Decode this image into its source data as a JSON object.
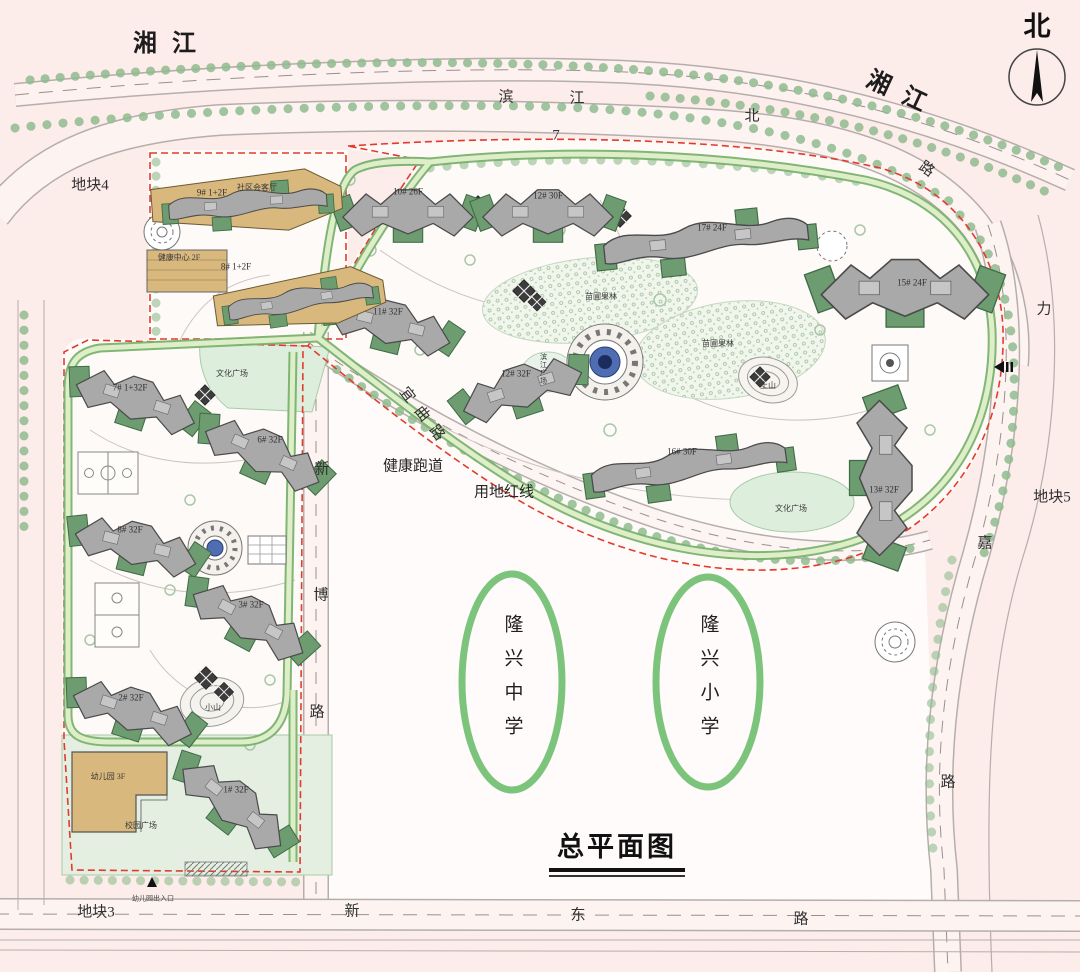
{
  "title": "总平面图",
  "compass": {
    "label": "北"
  },
  "colors": {
    "background": "#fcecea",
    "parcel_fill": "#fefaf8",
    "building_gray": "#a9a9a9",
    "building_green": "#6d9c70",
    "commercial_tan": "#d9b87d",
    "track_green": "#7ab26e",
    "track_inner": "#ddeec9",
    "red_line": "#e23b2e",
    "plaza_green": "#ddeedd",
    "school_ellipse_green": "#7cc47c"
  },
  "schools": [
    {
      "name": "隆兴中学"
    },
    {
      "name": "隆兴小学"
    }
  ],
  "map": {
    "labels": [
      {
        "id": "river-name-left",
        "text": "湘江",
        "x": 172,
        "y": 44,
        "cls": "lbl-lg"
      },
      {
        "id": "river-name-right",
        "text": "湘江",
        "x": 903,
        "y": 95,
        "cls": "lbl-lg",
        "rot": 25
      },
      {
        "id": "road-binjiang-char-bin",
        "text": "滨",
        "x": 506,
        "y": 98,
        "cls": "lbl-road"
      },
      {
        "id": "road-binjiang-char-jiang",
        "text": "江",
        "x": 577,
        "y": 99,
        "cls": "lbl-road"
      },
      {
        "id": "road-binjiang-char-bei",
        "text": "北",
        "x": 752,
        "y": 117,
        "cls": "lbl-road"
      },
      {
        "id": "road-binjiang-char-lu",
        "text": "路",
        "x": 926,
        "y": 170,
        "cls": "lbl-road",
        "rot": 35
      },
      {
        "id": "numeral-7",
        "text": "7",
        "x": 556,
        "y": 136,
        "cls": "lbl-road"
      },
      {
        "id": "parcel-4",
        "text": "地块4",
        "x": 90,
        "y": 186,
        "cls": "lbl-parcel"
      },
      {
        "id": "parcel-3",
        "text": "地块3",
        "x": 96,
        "y": 913,
        "cls": "lbl-parcel"
      },
      {
        "id": "parcel-5",
        "text": "地块5",
        "x": 1052,
        "y": 498,
        "cls": "lbl-parcel"
      },
      {
        "id": "road-xinbo-char-xin",
        "text": "新",
        "x": 322,
        "y": 470,
        "cls": "lbl-road"
      },
      {
        "id": "road-xinbo-char-bo",
        "text": "博",
        "x": 321,
        "y": 596,
        "cls": "lbl-road"
      },
      {
        "id": "road-xinbo-char-lu",
        "text": "路",
        "x": 317,
        "y": 713,
        "cls": "lbl-road"
      },
      {
        "id": "road-xindong-char-xin",
        "text": "新",
        "x": 352,
        "y": 912,
        "cls": "lbl-road"
      },
      {
        "id": "road-xindong-char-dong",
        "text": "东",
        "x": 578,
        "y": 916,
        "cls": "lbl-road"
      },
      {
        "id": "road-xindong-char-lu",
        "text": "路",
        "x": 801,
        "y": 920,
        "cls": "lbl-road"
      },
      {
        "id": "road-lijia-char-li",
        "text": "力",
        "x": 1044,
        "y": 310,
        "cls": "lbl-road"
      },
      {
        "id": "road-lijia-char-jia",
        "text": "嘉",
        "x": 985,
        "y": 544,
        "cls": "lbl-road"
      },
      {
        "id": "road-lijia-char-lu",
        "text": "路",
        "x": 948,
        "y": 783,
        "cls": "lbl-road"
      },
      {
        "id": "road-yiqu",
        "text": "宜曲路",
        "x": 424,
        "y": 418,
        "cls": "lbl-road lbl-spaced",
        "rot": 52
      },
      {
        "id": "note-health-track",
        "text": "健康跑道",
        "x": 413,
        "y": 467,
        "cls": "lbl-note"
      },
      {
        "id": "note-red-line",
        "text": "用地红线",
        "x": 504,
        "y": 493,
        "cls": "lbl-note"
      },
      {
        "id": "plaza-culture-west",
        "text": "文化广场",
        "x": 232,
        "y": 374,
        "cls": "lbl-tiny"
      },
      {
        "id": "plaza-culture-east",
        "text": "文化广场",
        "x": 791,
        "y": 509,
        "cls": "lbl-tiny"
      },
      {
        "id": "plaza-binjiang",
        "text": "滨江广场",
        "x": 543,
        "y": 369,
        "cls": "lbl-vtiny"
      },
      {
        "id": "hill-east",
        "text": "土山",
        "x": 768,
        "y": 386,
        "cls": "lbl-tiny"
      },
      {
        "id": "hill-west",
        "text": "小山",
        "x": 213,
        "y": 708,
        "cls": "lbl-tiny"
      },
      {
        "id": "orchard-north",
        "text": "苗圃果林",
        "x": 601,
        "y": 297,
        "cls": "lbl-tiny"
      },
      {
        "id": "orchard-south",
        "text": "苗圃果林",
        "x": 718,
        "y": 344,
        "cls": "lbl-tiny"
      },
      {
        "id": "community-hall",
        "text": "社区会客厅",
        "x": 257,
        "y": 188,
        "cls": "lbl-tiny"
      },
      {
        "id": "health-center",
        "text": "健康中心 2F",
        "x": 179,
        "y": 258,
        "cls": "lbl-tiny"
      },
      {
        "id": "kindergarten",
        "text": "幼儿园 3F",
        "x": 108,
        "y": 777,
        "cls": "lbl-tiny"
      },
      {
        "id": "campus-plaza",
        "text": "校园广场",
        "x": 141,
        "y": 826,
        "cls": "lbl-tiny"
      },
      {
        "id": "kindergarten-entrance",
        "text": "幼儿园出入口",
        "x": 153,
        "y": 899,
        "cls": "lbl-micro"
      },
      {
        "id": "bldg-10",
        "text": "10# 26F",
        "x": 408,
        "y": 192,
        "cls": "lbl-bldg"
      },
      {
        "id": "bldg-12",
        "text": "12# 30F",
        "x": 548,
        "y": 196,
        "cls": "lbl-bldg"
      },
      {
        "id": "bldg-17",
        "text": "17# 24F",
        "x": 712,
        "y": 228,
        "cls": "lbl-bldg"
      },
      {
        "id": "bldg-15",
        "text": "15# 24F",
        "x": 912,
        "y": 283,
        "cls": "lbl-bldg"
      },
      {
        "id": "bldg-11",
        "text": "11# 32F",
        "x": 388,
        "y": 312,
        "cls": "lbl-bldg"
      },
      {
        "id": "bldg-12b",
        "text": "12# 32F",
        "x": 516,
        "y": 374,
        "cls": "lbl-bldg"
      },
      {
        "id": "bldg-16",
        "text": "16# 30F",
        "x": 682,
        "y": 452,
        "cls": "lbl-bldg"
      },
      {
        "id": "bldg-13",
        "text": "13# 32F",
        "x": 884,
        "y": 490,
        "cls": "lbl-bldg"
      },
      {
        "id": "bldg-7",
        "text": "7# 1+32F",
        "x": 130,
        "y": 388,
        "cls": "lbl-bldg"
      },
      {
        "id": "bldg-6",
        "text": "6# 32F",
        "x": 270,
        "y": 440,
        "cls": "lbl-bldg"
      },
      {
        "id": "bldg-8",
        "text": "8# 32F",
        "x": 130,
        "y": 530,
        "cls": "lbl-bldg"
      },
      {
        "id": "bldg-3",
        "text": "3# 32F",
        "x": 251,
        "y": 605,
        "cls": "lbl-bldg"
      },
      {
        "id": "bldg-2",
        "text": "2# 32F",
        "x": 131,
        "y": 698,
        "cls": "lbl-bldg"
      },
      {
        "id": "bldg-1",
        "text": "1# 32F",
        "x": 236,
        "y": 790,
        "cls": "lbl-bldg"
      },
      {
        "id": "bldg-9-commercial",
        "text": "9# 1+2F",
        "x": 212,
        "y": 193,
        "cls": "lbl-bldg"
      },
      {
        "id": "bldg-8-commercial",
        "text": "8# 1+2F",
        "x": 236,
        "y": 267,
        "cls": "lbl-bldg"
      },
      {
        "id": "school-middle",
        "text": "隆兴中学",
        "x": 512,
        "y": 682,
        "cls": "lbl-school"
      },
      {
        "id": "school-primary",
        "text": "隆兴小学",
        "x": 708,
        "y": 682,
        "cls": "lbl-school"
      }
    ]
  }
}
